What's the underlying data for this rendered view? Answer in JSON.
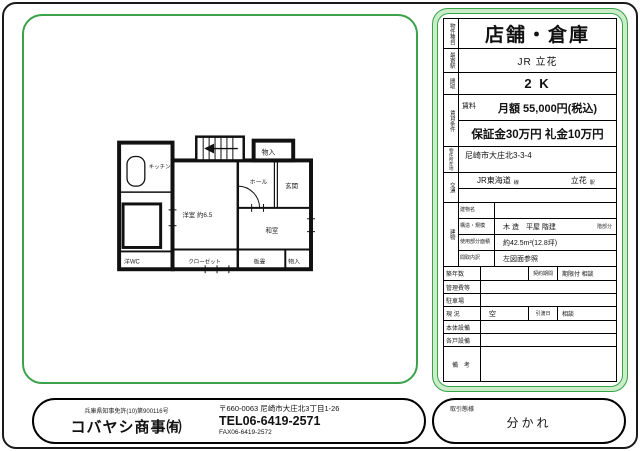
{
  "colors": {
    "frame_green": "#3aa34a",
    "frame_green_light": "#c9ecc9",
    "ink": "#111111"
  },
  "property": {
    "type_label": "物件種目",
    "type": "店舗・倉庫",
    "station_label": "最寄駅",
    "station": "JR 立花",
    "layout_label": "間取",
    "layout": "2 K",
    "rent_label": "賃貸条件",
    "rent_sub_label": "賃料",
    "rent_monthly": "月額 55,000円(税込)",
    "rent_deposit": "保証金30万円 礼金10万円",
    "address_label": "物件所在地",
    "address": "尼崎市大庄北3-3-4",
    "access_label": "交通",
    "access_line": "JR東海道",
    "access_line_suffix": "線",
    "access_station": "立花",
    "access_station_suffix": "駅",
    "building_label": "建物",
    "building_name_label": "建物名",
    "building_name": "",
    "structure_label": "構造・規模",
    "structure": "木 造　平屋 階建",
    "structure_suffix": "階部分",
    "area_label": "使用部分面積",
    "area": "約42.5m²(12.8坪)",
    "layout_detail_label": "間取内訳",
    "layout_detail": "左図面参照",
    "age_label": "築年数",
    "age": "",
    "contract_label": "契約期間",
    "contract": "期限付 相談",
    "mgmt_label": "管理費等",
    "mgmt": "",
    "parking_label": "駐車場",
    "parking": "",
    "status_label": "現 況",
    "status": "空",
    "handover_label": "引渡日",
    "handover": "相談",
    "main_equip_label": "本体設備",
    "main_equip": "",
    "unit_equip_label": "各戸設備",
    "unit_equip": "",
    "remarks_label": "備 考",
    "remarks": ""
  },
  "floorplan": {
    "rooms": {
      "kitchen": "キッチン",
      "storage_top": "物入",
      "entrance": "玄関",
      "hall": "ホール",
      "western_room": "洋室 約6.5",
      "japanese_room": "和室",
      "board_room": "板畳",
      "closet": "クローゼット",
      "wc": "洋WC",
      "storage_bottom": "物入"
    }
  },
  "footer": {
    "license": "兵庫県知事免許(10)第900116号",
    "company": "コバヤシ商事㈲",
    "postal_address": "〒660-0063 尼崎市大庄北3丁目1-26",
    "tel": "TEL06-6419-2571",
    "fax": "FAX06-6419-2572",
    "deal_type_label": "取引態様",
    "deal_type": "分かれ"
  }
}
